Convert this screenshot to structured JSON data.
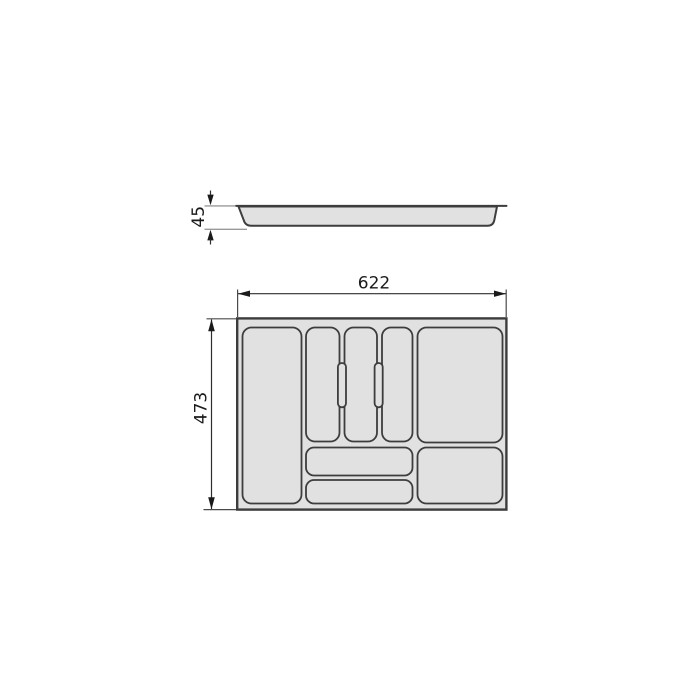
{
  "drawing": {
    "kind": "technical-dimension-drawing",
    "subject": "drawer-cutlery-tray-insert",
    "labels": {
      "width": "622",
      "depth": "473",
      "height": "45"
    }
  },
  "colors": {
    "background": "#ffffff",
    "tray_fill": "#e1e1e1",
    "outline": "#3d3d3d",
    "dimension_text": "#1a1a1a",
    "dimension_line": "#2e2e2e",
    "reference_line": "#9a9a9a"
  }
}
